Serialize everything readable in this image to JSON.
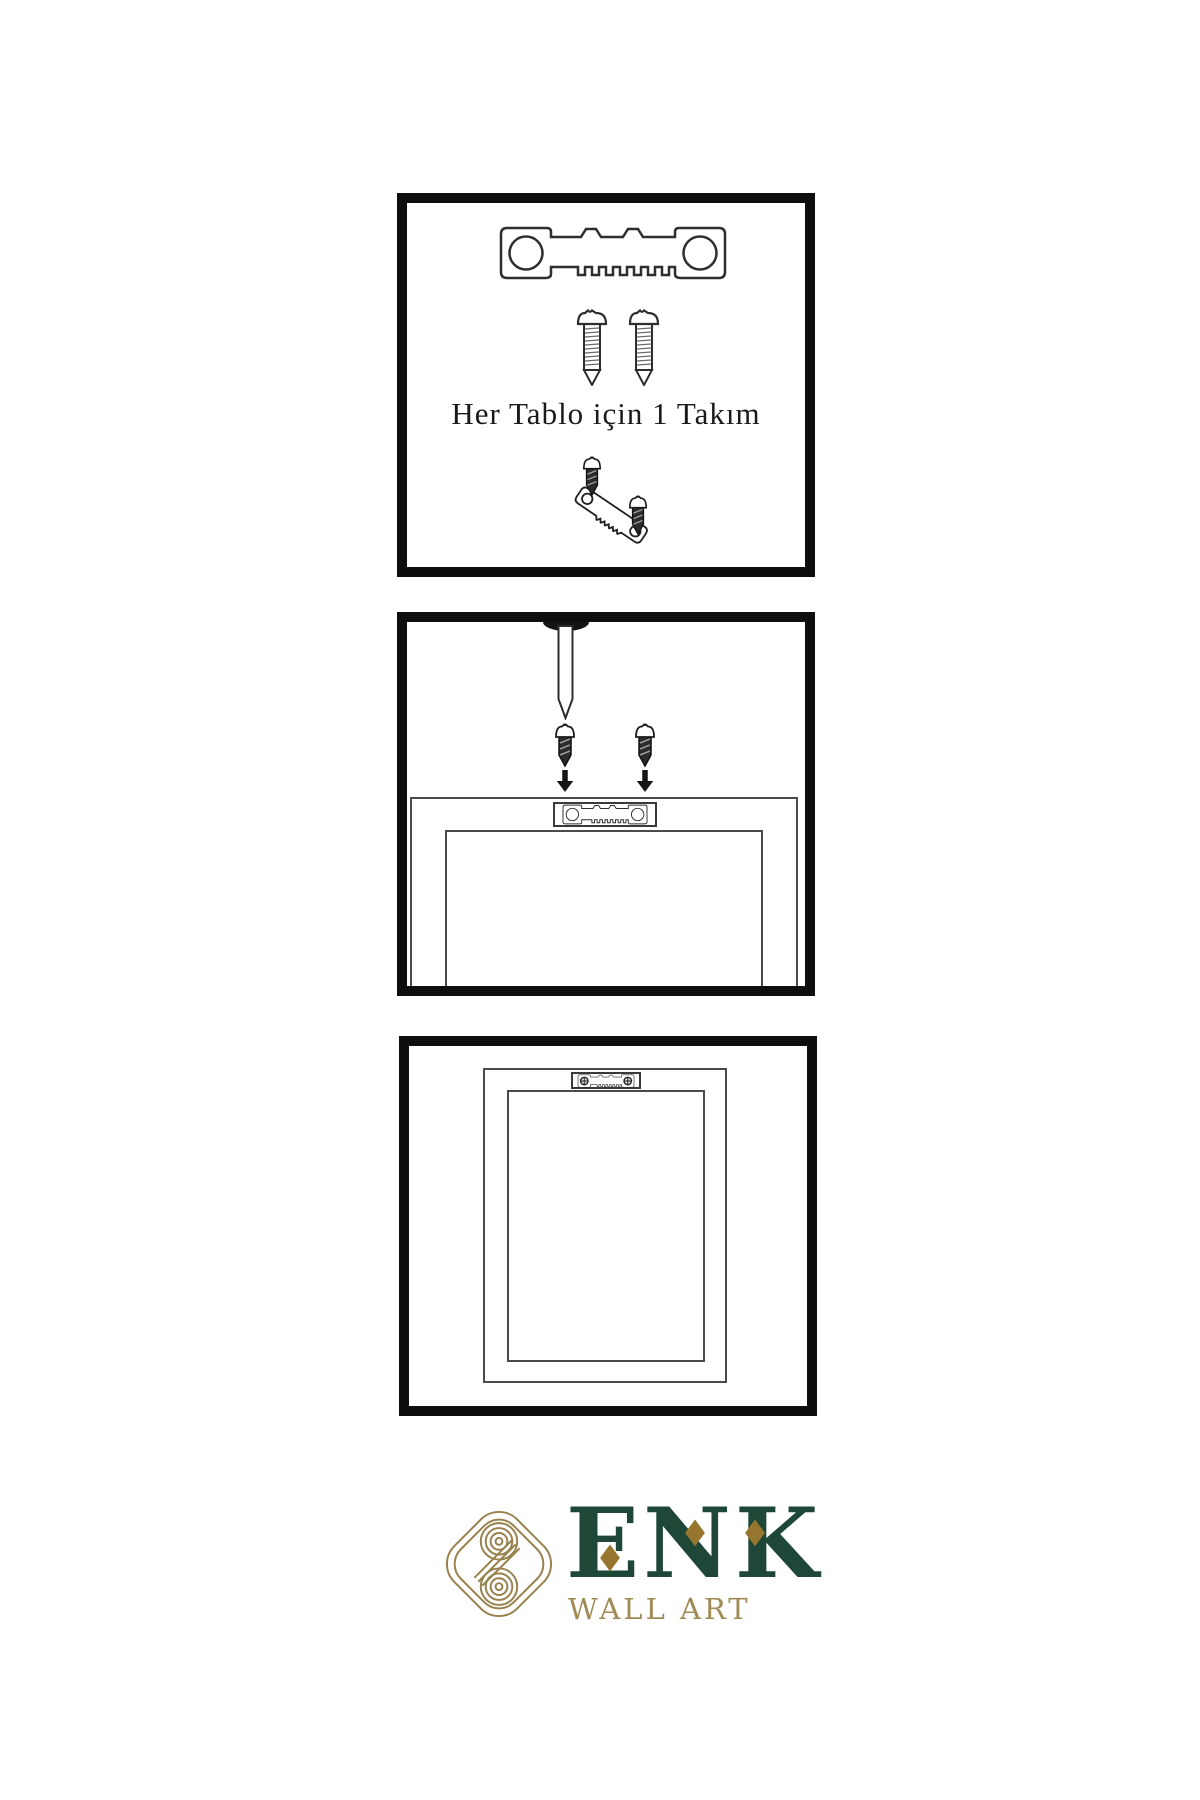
{
  "canvas": {
    "background": "#ffffff",
    "width": 1200,
    "height": 1800
  },
  "colors": {
    "panel_border": "#0e0e0e",
    "outline": "#2e2e2e",
    "frame_line": "#4a4a4a",
    "screw_dark_fill": "#2b2b2b",
    "logo_green": "#1e4738",
    "logo_gold": "#97824d",
    "diamond_gold": "#96762f",
    "wallart_gold": "#a08a55"
  },
  "panels": {
    "kit": {
      "caption": "Her Tablo için 1 Takım",
      "icons": [
        "sawtooth-hanger-icon",
        "screw-icon",
        "screw-icon",
        "small-screw-icon",
        "angled-sawtooth-hanger-icon",
        "small-screw-icon"
      ]
    },
    "install": {
      "icons": [
        "nail-icon",
        "small-screw-icon",
        "small-screw-icon",
        "arrow-down-icon",
        "arrow-down-icon",
        "sawtooth-hanger-icon",
        "frame-back-icon"
      ]
    },
    "hang": {
      "icons": [
        "frame-back-icon",
        "mounted-sawtooth-hanger-icon"
      ]
    }
  },
  "logo": {
    "title": "ENK",
    "subtitle": "WALL ART",
    "icons": [
      "knot-logo-icon",
      "diamond-icon",
      "diamond-icon",
      "diamond-icon"
    ]
  }
}
